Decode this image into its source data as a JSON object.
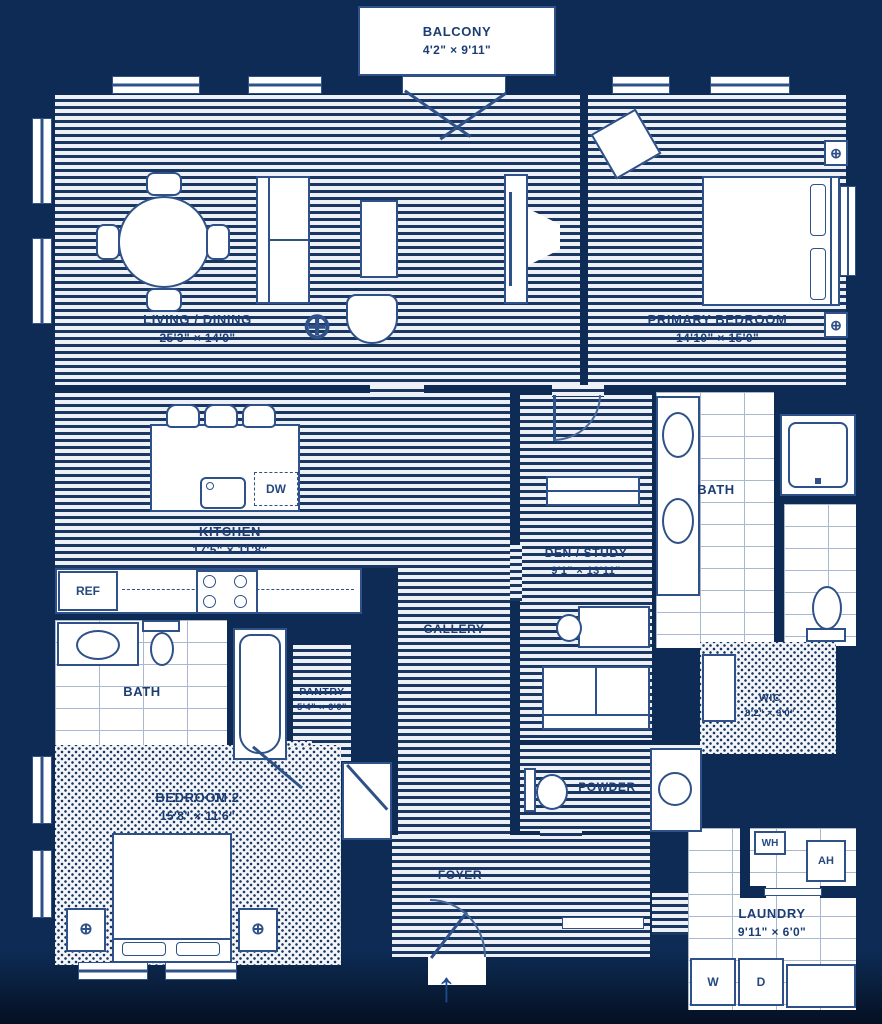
{
  "plan": {
    "colors": {
      "wall": "#0d2b55",
      "fixture_line": "#2d5188",
      "label_text": "#1c3d74"
    },
    "balcony": {
      "name": "BALCONY",
      "dims": "4'2\" × 9'11\""
    },
    "rooms": {
      "living": {
        "name": "LIVING / DINING",
        "dims": "25'3\" × 14'9\""
      },
      "primary": {
        "name": "PRIMARY BEDROOM",
        "dims": "14'10\" × 15'0\""
      },
      "kitchen": {
        "name": "KITCHEN",
        "dims": "17'5\" × 11'8\""
      },
      "den": {
        "name": "DEN / STUDY",
        "dims": "9'1\" × 13'11\""
      },
      "gallery": {
        "name": "GALLERY"
      },
      "pantry": {
        "name": "PANTRY",
        "dims": "5'4\" × 6'0\""
      },
      "bath2": {
        "name": "BATH"
      },
      "primary_bath": {
        "name": "BATH"
      },
      "bedroom2": {
        "name": "BEDROOM 2",
        "dims": "15'8\" × 11'6\""
      },
      "wic": {
        "name": "WIC",
        "dims": "8'2\" × 9'0\""
      },
      "powder": {
        "name": "POWDER"
      },
      "foyer": {
        "name": "FOYER"
      },
      "laundry": {
        "name": "LAUNDRY",
        "dims": "9'11\" × 6'0\""
      }
    },
    "appliances": {
      "ref": "REF",
      "dw": "DW",
      "wh": "WH",
      "ah": "AH",
      "washer": "W",
      "dryer": "D"
    },
    "icons": {
      "lamp": "⊕",
      "arrow_up": "↑"
    }
  }
}
